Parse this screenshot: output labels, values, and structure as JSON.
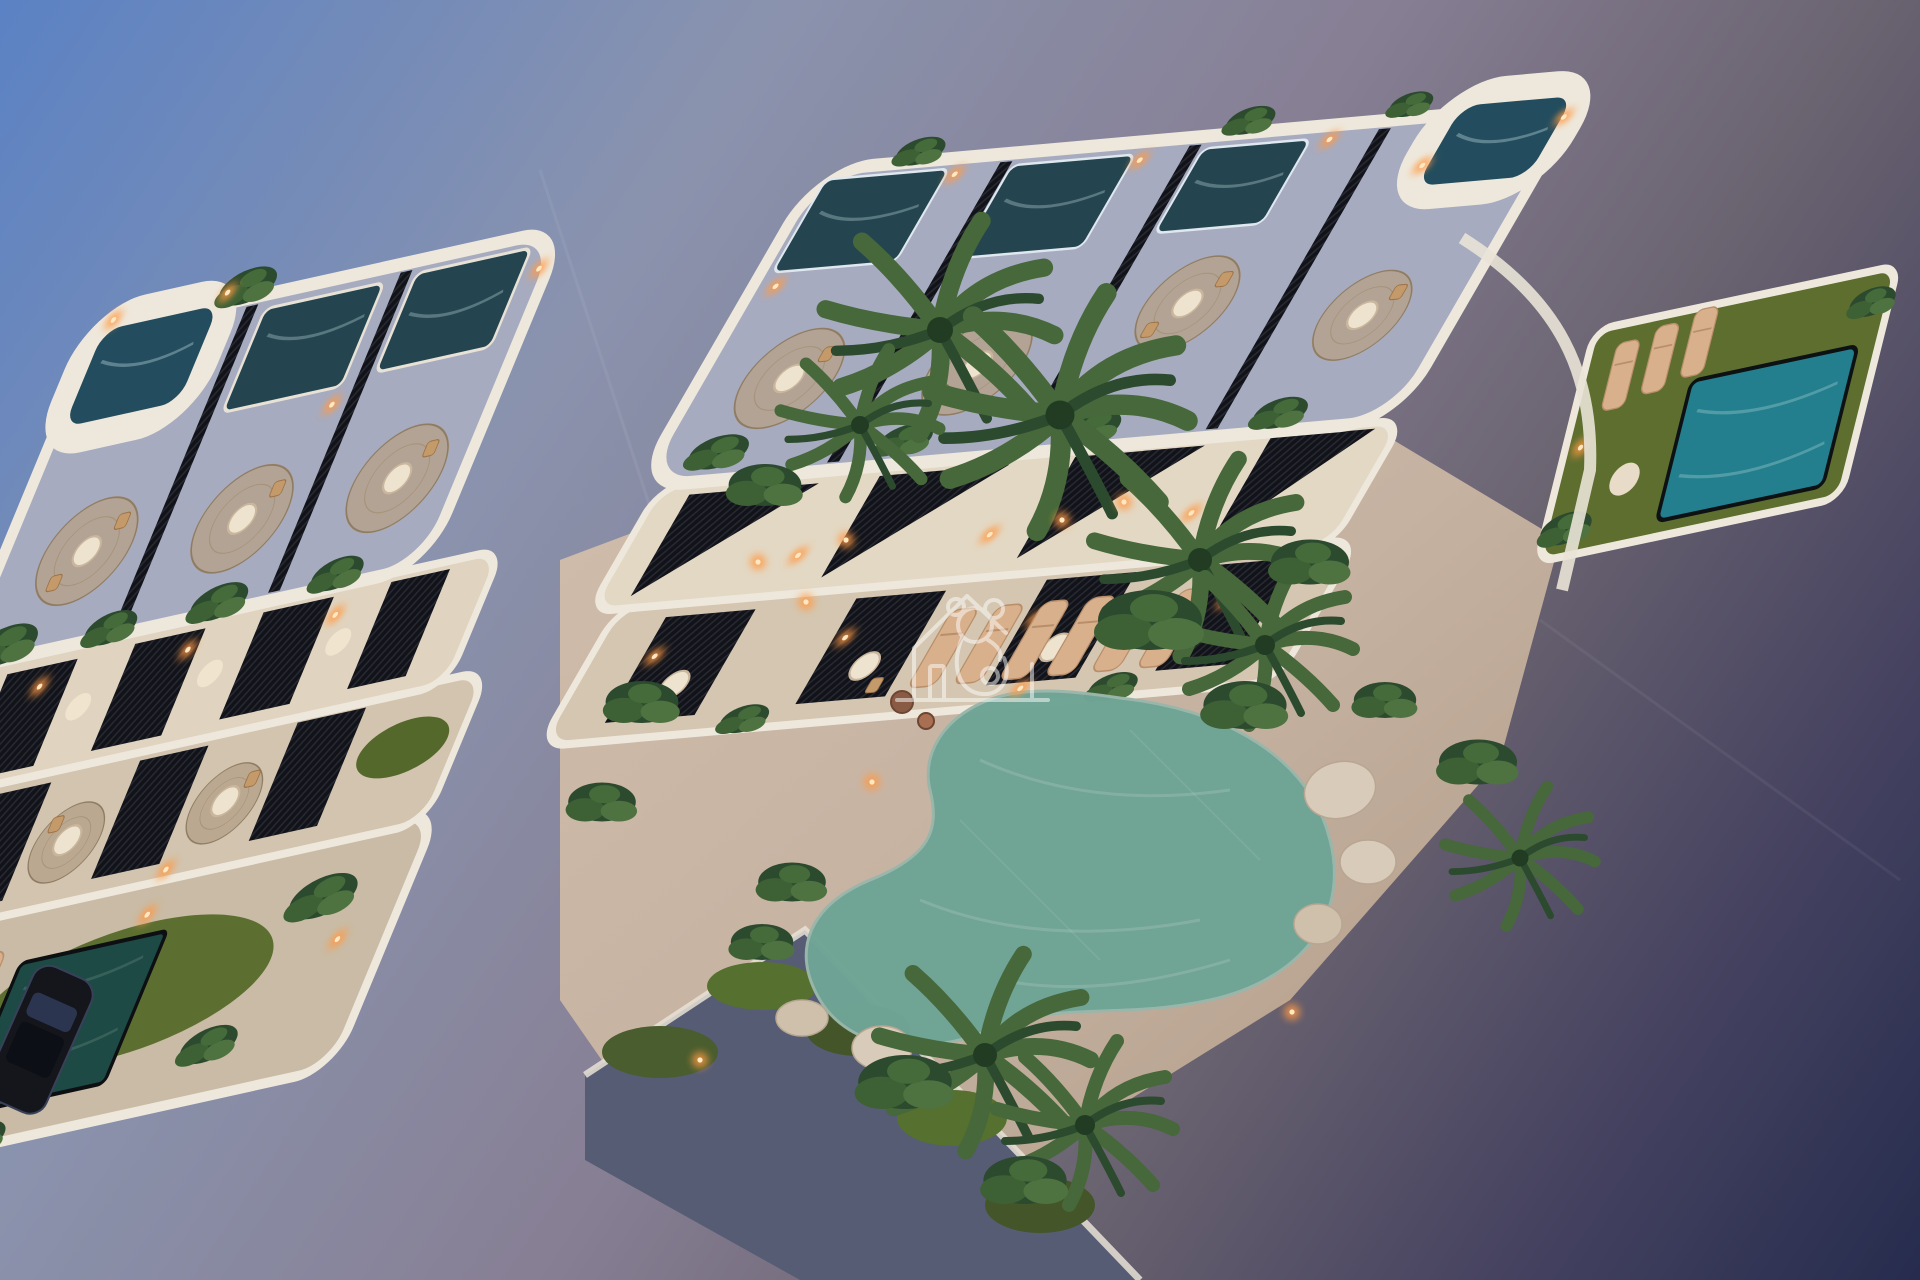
{
  "meta": {
    "type": "architectural-3d-render",
    "description": "Aerial dusk view of a modern two-building apartment complex with curved white balconies, rooftop terraces with plunge pools, black slatted privacy screens, tropical landscaping, sun loungers and a free-form courtyard swimming pool",
    "time_of_day": "dusk",
    "visible_text": ""
  },
  "watermark": {
    "icon": "house-koala-logo-icon",
    "color": "#ffffff",
    "opacity": "0.5"
  },
  "scene": {
    "colors": {
      "ground_top_left": "#5b82c4",
      "ground_mid": "#8a93ae",
      "ground_lower": "#6a6370",
      "ground_bottom_right": "#262c4e",
      "building_white": "#eee8dc",
      "roof_deck": "#a6abc0",
      "terrace_cream": "#e0d4c0",
      "terrace_warm": "#cdb9a3",
      "courtyard_deck": "#c6b2a1",
      "courtyard_pool_water": "#6fa495",
      "plunge_pool_water": "#24454f",
      "rooftop_pool_water": "#234d5e",
      "private_pool_water": "#237f8d",
      "square_pool_water": "#1d4a44",
      "grass": "#5c6f31",
      "foliage_dark": "#2c4a2e",
      "foliage_mid": "#3d6135",
      "foliage_light": "#4e7340",
      "warm_light": "#ff9a45",
      "dark_slats": "#17181c",
      "lounger_tan": "#d8b08c",
      "rug_jute": "#b5a188",
      "planter_wall": "#565c74",
      "car_body": "#14161c"
    }
  }
}
